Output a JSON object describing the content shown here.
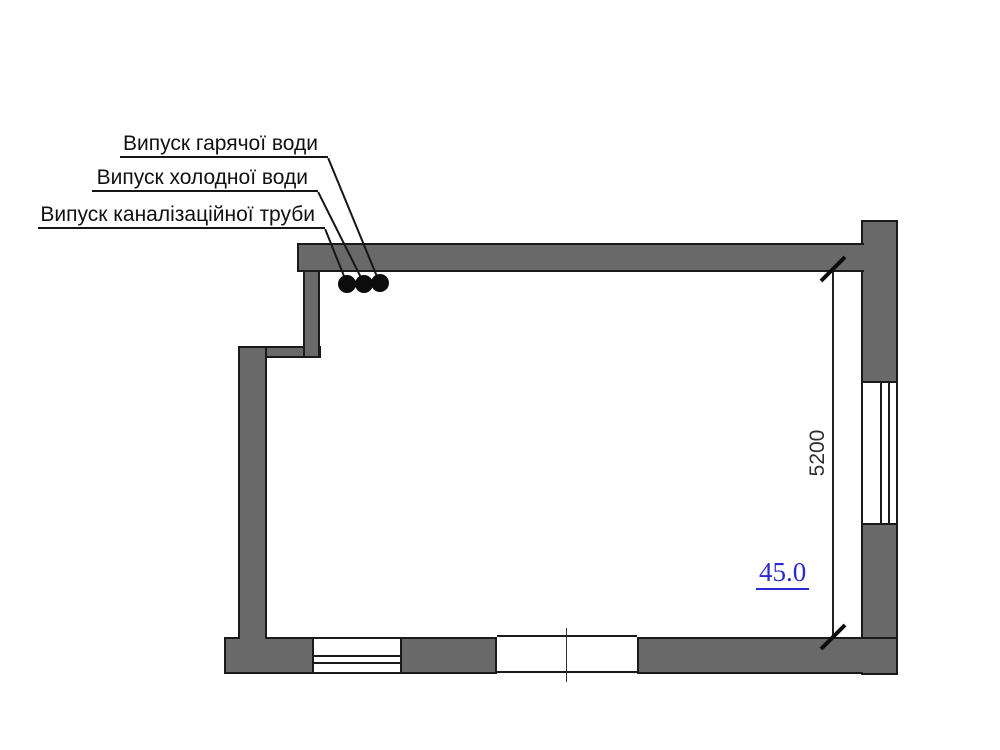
{
  "drawing": {
    "callouts": [
      {
        "label": "Випуск гарячої води"
      },
      {
        "label": "Випуск холодної води"
      },
      {
        "label": "Випуск каналізаційної труби"
      }
    ],
    "dimension_label": "5200",
    "area_label": "45.0"
  },
  "colors": {
    "wall_fill": "#696969",
    "line": "#1a1a1a",
    "area_text": "#2b2bcc"
  }
}
